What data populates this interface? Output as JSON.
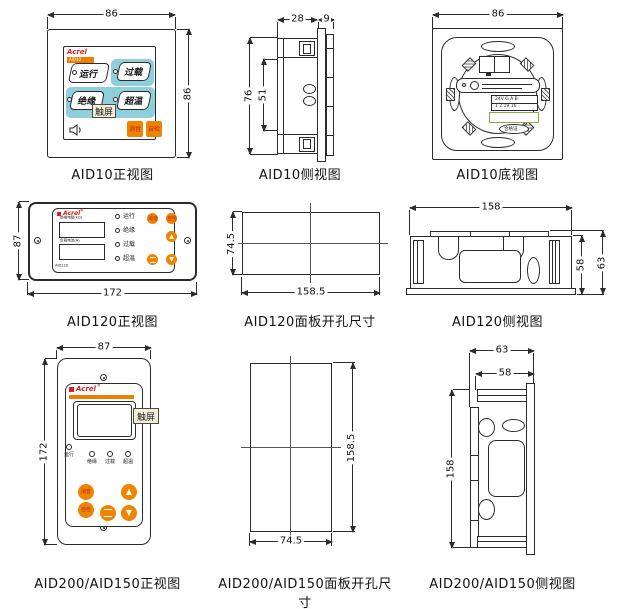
{
  "colors": {
    "teal": "#8ecfdb",
    "orange": "#f08300",
    "logo_red": "#d61f26",
    "button_text_red": "#b42518",
    "tag_beige": "#f4eed8",
    "green_outline": "#7cb342",
    "line": "#2b2b2b"
  },
  "figures": {
    "aid10_front": {
      "caption": "AID10正视图",
      "dim_top": "86",
      "dim_right": "86",
      "logo": "Acrel",
      "logo_model": "AID10",
      "btn_run": "运行",
      "btn_overload": "过载",
      "btn_insulation": "绝缘",
      "btn_overtemp": "超温",
      "btn_mute": "消音",
      "btn_selfcheck": "自检",
      "tag_touchscreen": "触屏"
    },
    "aid10_side": {
      "caption": "AID10侧视图",
      "dim_depth": "28",
      "dim_panel": "9",
      "dim_height": "76",
      "dim_inner": "51"
    },
    "aid10_bottom": {
      "caption": "AID10底视图",
      "dim_top": "86",
      "terminal_line1": "24V G A B",
      "terminal_line2": "1 2 19 16",
      "cert_label": "合格证"
    },
    "aid120_front": {
      "caption": "AID120正视图",
      "dim_left": "87",
      "dim_bottom": "172",
      "logo": "Acrel",
      "logo_sup": "®",
      "model": "AID120",
      "display1_label": "绝缘电阻(kΩ)",
      "display2_label": "负载电流(A)",
      "ind_run": "运行",
      "ind_insulation": "绝缘",
      "ind_overload": "过载",
      "ind_overtemp": "超温",
      "btn_mute": "消音",
      "btn_selfcheck": "自检",
      "glyph_up": "▲",
      "glyph_down": "▼"
    },
    "aid120_cutout": {
      "caption": "AID120面板开孔尺寸",
      "dim_left": "74.5",
      "dim_bottom": "158.5"
    },
    "aid120_side": {
      "caption": "AID120侧视图",
      "dim_top": "158",
      "dim_inner": "58",
      "dim_total": "63"
    },
    "aid200_front": {
      "caption": "AID200/AID150正视图",
      "dim_top": "87",
      "dim_left": "172",
      "logo": "Acrel",
      "logo_sup": "®",
      "tag_touchscreen": "触屏",
      "ind_run": "运行",
      "ind_insulation": "绝缘",
      "ind_overload": "过载",
      "ind_overtemp": "超温",
      "btn_mute": "消音",
      "btn_selfcheck": "自检",
      "glyph_up": "▲",
      "glyph_down": "▼"
    },
    "aid200_cutout": {
      "caption": "AID200/AID150面板开孔尺寸",
      "dim_right": "158.5",
      "dim_bottom": "74.5"
    },
    "aid200_side": {
      "caption": "AID200/AID150侧视图",
      "dim_outer": "63",
      "dim_inner": "58",
      "dim_left": "158"
    }
  }
}
